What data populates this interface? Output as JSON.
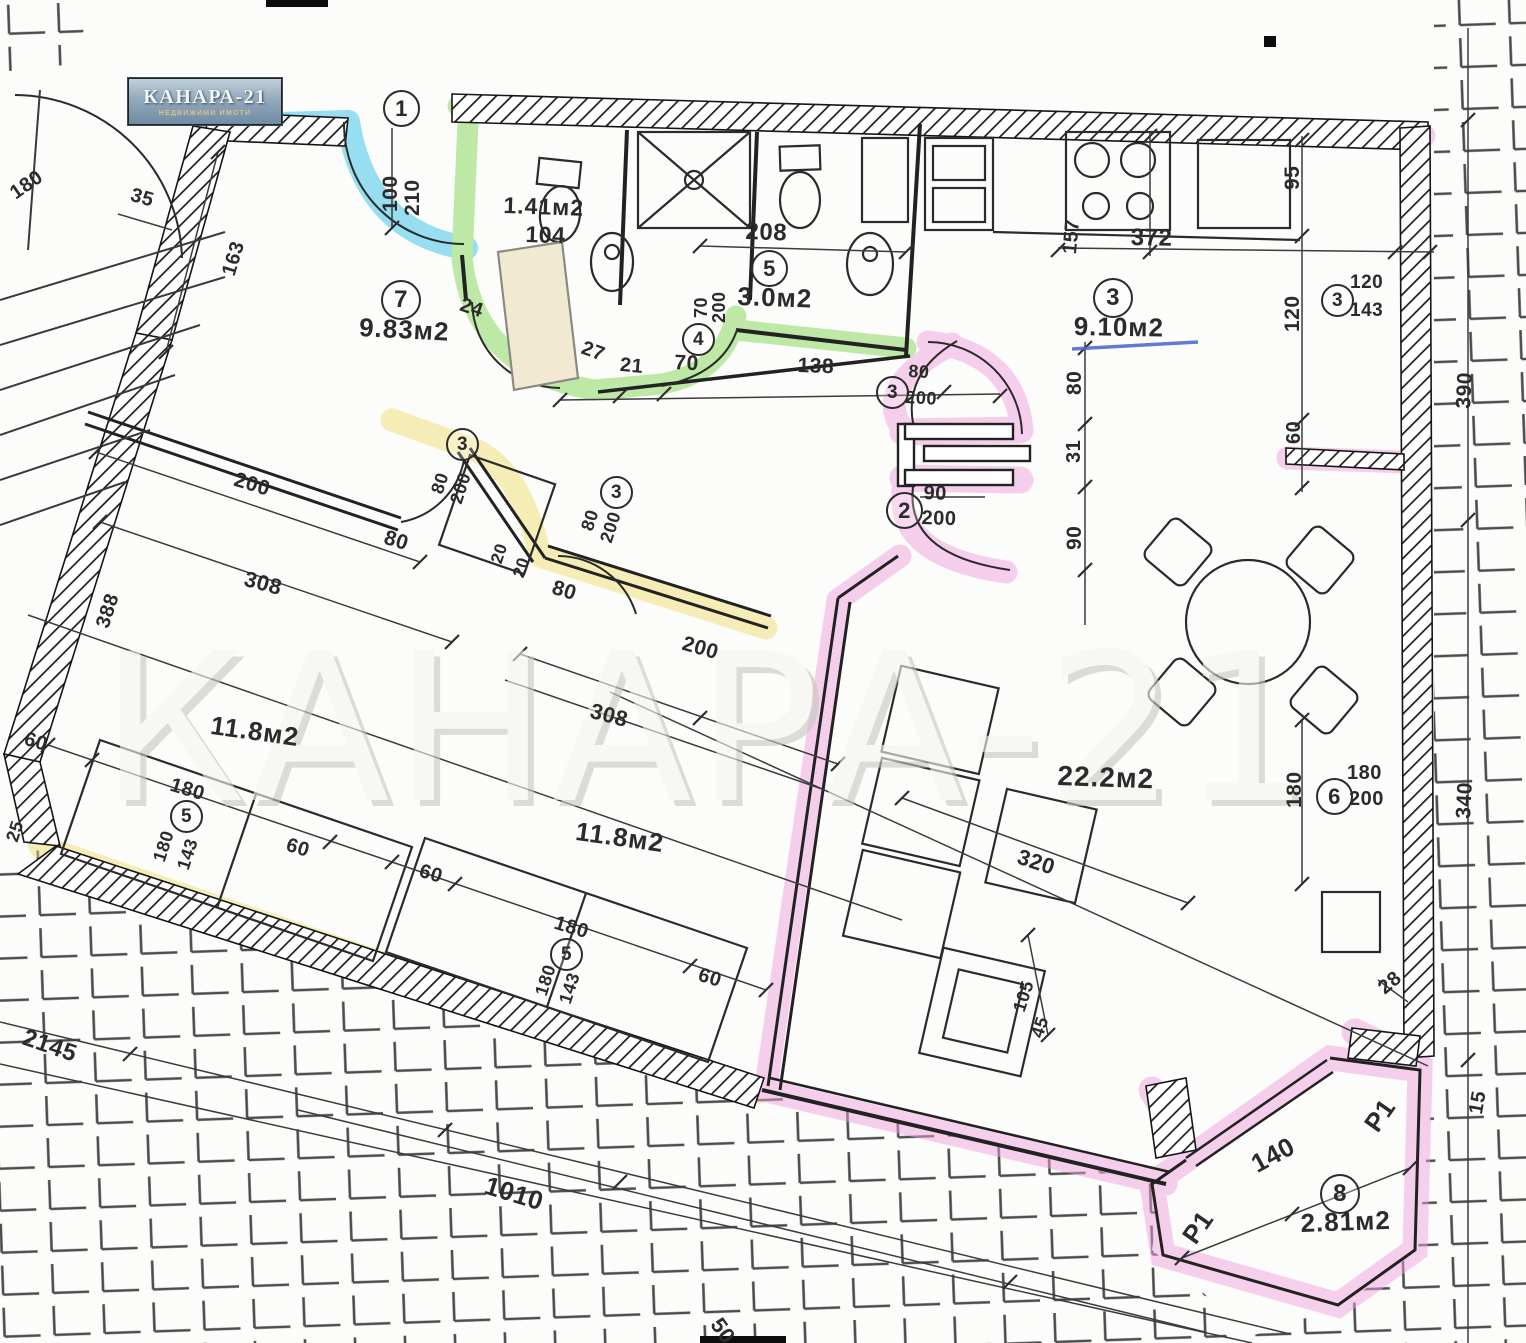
{
  "logo": {
    "title": "КАНАРА-21",
    "subtitle": "НЕДВИЖИМИ ИМОТИ"
  },
  "watermark": "КАНАРА-21",
  "colors": {
    "highlight_blue": "#35c4e8",
    "highlight_green": "#7fd653",
    "highlight_yellow": "#f2df74",
    "highlight_pink": "#efa2de",
    "pen_underline": "#4466cc",
    "ink": "#2b2b2b"
  },
  "rooms": [
    {
      "ref": "7",
      "area": "9.83м2"
    },
    {
      "ref": "",
      "area": "1.41м2"
    },
    {
      "ref": "5",
      "area": "3.0м2"
    },
    {
      "ref": "3",
      "area": "9.10м2"
    },
    {
      "ref": "",
      "area": "11.8м2"
    },
    {
      "ref": "",
      "area": "11.8м2"
    },
    {
      "ref": "",
      "area": "22.2м2"
    },
    {
      "ref": "8",
      "area": "2.81м2"
    }
  ],
  "labels": [
    {
      "t": "1",
      "c": true,
      "x": 383,
      "y": 90,
      "s": 22
    },
    {
      "t": "100",
      "x": 379,
      "y": 212,
      "r": -90,
      "s": 21
    },
    {
      "t": "210",
      "x": 401,
      "y": 216,
      "r": -90,
      "s": 21
    },
    {
      "t": "180",
      "x": 6,
      "y": 186,
      "r": -35,
      "s": 20
    },
    {
      "t": "35",
      "x": 134,
      "y": 184,
      "r": 16,
      "s": 20
    },
    {
      "t": "163",
      "x": 218,
      "y": 272,
      "r": -73,
      "s": 20
    },
    {
      "t": "7",
      "c": true,
      "x": 381,
      "y": 280,
      "s": 24
    },
    {
      "t": "9.83м2",
      "n": "room-area",
      "x": 360,
      "y": 312,
      "r": 3,
      "s": 26
    },
    {
      "t": "24",
      "x": 464,
      "y": 294,
      "r": 18,
      "s": 20
    },
    {
      "t": "1.41м2",
      "n": "room-area",
      "x": 504,
      "y": 192,
      "r": 2,
      "s": 23
    },
    {
      "t": "104",
      "x": 526,
      "y": 221,
      "r": 2,
      "s": 23
    },
    {
      "t": "4",
      "c": true,
      "x": 682,
      "y": 323,
      "s": 19
    },
    {
      "t": "70",
      "x": 691,
      "y": 318,
      "r": -90,
      "s": 18
    },
    {
      "t": "200",
      "x": 709,
      "y": 323,
      "r": -90,
      "s": 18
    },
    {
      "t": "208",
      "x": 746,
      "y": 218,
      "r": 2,
      "s": 24
    },
    {
      "t": "5",
      "c": true,
      "x": 751,
      "y": 250,
      "s": 22
    },
    {
      "t": "3.0м2",
      "n": "room-area",
      "x": 738,
      "y": 281,
      "r": 2,
      "s": 26
    },
    {
      "t": "27",
      "x": 586,
      "y": 337,
      "r": 20,
      "s": 20
    },
    {
      "t": "21",
      "x": 621,
      "y": 354,
      "r": 5,
      "s": 20
    },
    {
      "t": "70",
      "x": 675,
      "y": 351,
      "r": 3,
      "s": 21
    },
    {
      "t": "138",
      "x": 798,
      "y": 354,
      "r": 2,
      "s": 21
    },
    {
      "t": "3",
      "c": true,
      "x": 876,
      "y": 376,
      "s": 19
    },
    {
      "t": "80",
      "x": 909,
      "y": 361,
      "r": 3,
      "s": 18
    },
    {
      "t": "200",
      "x": 906,
      "y": 387,
      "r": 3,
      "s": 18
    },
    {
      "t": "95",
      "x": 1281,
      "y": 190,
      "r": -90,
      "s": 21
    },
    {
      "t": "157",
      "x": 1059,
      "y": 253,
      "r": -85,
      "s": 20
    },
    {
      "t": "372",
      "x": 1131,
      "y": 224,
      "r": 1,
      "s": 24
    },
    {
      "t": "3",
      "c": true,
      "x": 1093,
      "y": 278,
      "s": 24
    },
    {
      "t": "9.10м2",
      "n": "room-area",
      "x": 1074,
      "y": 311,
      "r": 1,
      "s": 26
    },
    {
      "t": "3",
      "c": true,
      "x": 1321,
      "y": 284,
      "s": 19
    },
    {
      "t": "120",
      "x": 1350,
      "y": 272,
      "s": 19
    },
    {
      "t": "143",
      "x": 1350,
      "y": 300,
      "s": 19
    },
    {
      "t": "390",
      "x": 1452,
      "y": 408,
      "r": -87,
      "s": 21
    },
    {
      "t": "120",
      "x": 1281,
      "y": 332,
      "r": -90,
      "s": 21
    },
    {
      "t": "60",
      "x": 1283,
      "y": 444,
      "r": -90,
      "s": 20
    },
    {
      "t": "80",
      "x": 1063,
      "y": 395,
      "r": -90,
      "s": 21
    },
    {
      "t": "31",
      "x": 1063,
      "y": 463,
      "r": -90,
      "s": 20
    },
    {
      "t": "2",
      "c": true,
      "x": 886,
      "y": 492,
      "s": 22
    },
    {
      "t": "90",
      "x": 924,
      "y": 482,
      "r": 2,
      "s": 20
    },
    {
      "t": "200",
      "x": 922,
      "y": 507,
      "r": 2,
      "s": 20
    },
    {
      "t": "90",
      "x": 1063,
      "y": 550,
      "r": -90,
      "s": 21
    },
    {
      "t": "3",
      "c": true,
      "x": 446,
      "y": 428,
      "s": 19
    },
    {
      "t": "80",
      "x": 427,
      "y": 490,
      "r": -72,
      "s": 18
    },
    {
      "t": "200",
      "x": 446,
      "y": 500,
      "r": -72,
      "s": 18
    },
    {
      "t": "200",
      "x": 238,
      "y": 468,
      "r": 17,
      "s": 21
    },
    {
      "t": "80",
      "x": 388,
      "y": 526,
      "r": 17,
      "s": 21
    },
    {
      "t": "3",
      "c": true,
      "x": 600,
      "y": 476,
      "s": 19
    },
    {
      "t": "80",
      "x": 577,
      "y": 527,
      "r": -72,
      "s": 18
    },
    {
      "t": "200",
      "x": 596,
      "y": 539,
      "r": -72,
      "s": 18
    },
    {
      "t": "20",
      "x": 487,
      "y": 560,
      "r": -72,
      "s": 17
    },
    {
      "t": "20",
      "x": 509,
      "y": 574,
      "r": -72,
      "s": 17
    },
    {
      "t": "80",
      "x": 556,
      "y": 576,
      "r": 17,
      "s": 21
    },
    {
      "t": "308",
      "x": 248,
      "y": 566,
      "r": 15,
      "s": 22
    },
    {
      "t": "388",
      "x": 92,
      "y": 624,
      "r": -72,
      "s": 20
    },
    {
      "t": "200",
      "x": 686,
      "y": 632,
      "r": 16,
      "s": 21
    },
    {
      "t": "308",
      "x": 594,
      "y": 698,
      "r": 15,
      "s": 22
    },
    {
      "t": "11.8м2",
      "n": "room-area",
      "x": 213,
      "y": 710,
      "r": 8,
      "s": 26
    },
    {
      "t": "11.8м2",
      "n": "room-area",
      "x": 578,
      "y": 816,
      "r": 8,
      "s": 26
    },
    {
      "t": "60",
      "x": 28,
      "y": 728,
      "r": 17,
      "s": 20
    },
    {
      "t": "180",
      "x": 174,
      "y": 774,
      "r": 17,
      "s": 20
    },
    {
      "t": "5",
      "c": true,
      "x": 170,
      "y": 800,
      "s": 19
    },
    {
      "t": "180",
      "x": 149,
      "y": 858,
      "r": -72,
      "s": 18
    },
    {
      "t": "143",
      "x": 173,
      "y": 866,
      "r": -72,
      "s": 18
    },
    {
      "t": "25",
      "x": 2,
      "y": 838,
      "r": -72,
      "s": 18
    },
    {
      "t": "60",
      "x": 290,
      "y": 834,
      "r": 17,
      "s": 20
    },
    {
      "t": "60",
      "x": 423,
      "y": 860,
      "r": 17,
      "s": 20
    },
    {
      "t": "180",
      "x": 558,
      "y": 912,
      "r": 17,
      "s": 20
    },
    {
      "t": "5",
      "c": true,
      "x": 550,
      "y": 938,
      "s": 19
    },
    {
      "t": "180",
      "x": 531,
      "y": 992,
      "r": -72,
      "s": 18
    },
    {
      "t": "143",
      "x": 555,
      "y": 1000,
      "r": -72,
      "s": 18
    },
    {
      "t": "60",
      "x": 702,
      "y": 964,
      "r": 17,
      "s": 20
    },
    {
      "t": "22.2м2",
      "n": "room-area",
      "x": 1058,
      "y": 760,
      "r": 2,
      "s": 28
    },
    {
      "t": "320",
      "x": 1022,
      "y": 844,
      "r": 18,
      "s": 22
    },
    {
      "t": "180",
      "x": 1283,
      "y": 808,
      "r": -90,
      "s": 21
    },
    {
      "t": "6",
      "c": true,
      "x": 1316,
      "y": 778,
      "s": 22
    },
    {
      "t": "180",
      "x": 1347,
      "y": 762,
      "s": 20
    },
    {
      "t": "200",
      "x": 1349,
      "y": 788,
      "s": 20
    },
    {
      "t": "340",
      "x": 1452,
      "y": 818,
      "r": -87,
      "s": 21
    },
    {
      "t": "105",
      "x": 1009,
      "y": 1008,
      "r": -72,
      "s": 18
    },
    {
      "t": "45",
      "x": 1027,
      "y": 1034,
      "r": -72,
      "s": 18
    },
    {
      "t": "28",
      "x": 1374,
      "y": 982,
      "r": -40,
      "s": 20
    },
    {
      "t": "140",
      "x": 1246,
      "y": 1152,
      "r": -28,
      "s": 26
    },
    {
      "t": "8",
      "c": true,
      "x": 1320,
      "y": 1174,
      "s": 24
    },
    {
      "t": "2.81м2",
      "n": "room-area",
      "x": 1300,
      "y": 1208,
      "r": -2,
      "s": 26
    },
    {
      "t": "Р1",
      "x": 1176,
      "y": 1232,
      "r": -55,
      "s": 26
    },
    {
      "t": "Р1",
      "x": 1358,
      "y": 1120,
      "r": -55,
      "s": 26
    },
    {
      "t": "15",
      "x": 1465,
      "y": 1112,
      "r": -80,
      "s": 20
    },
    {
      "t": "1010",
      "x": 490,
      "y": 1170,
      "r": 17,
      "s": 26
    },
    {
      "t": "2145",
      "x": 28,
      "y": 1024,
      "r": 19,
      "s": 24
    },
    {
      "t": "50",
      "x": 726,
      "y": 1313,
      "r": 55,
      "s": 22
    }
  ]
}
